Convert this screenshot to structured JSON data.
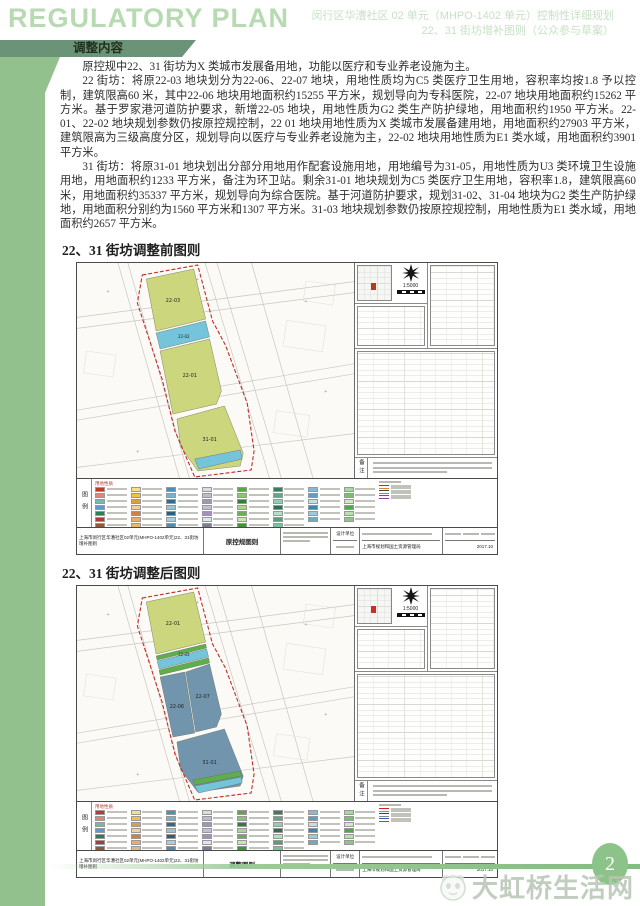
{
  "header": {
    "title_en": "REGULATORY PLAN",
    "subtitle_line1": "闵行区华漕社区 02 单元（MHPO-1402 单元）控制性详细规划",
    "subtitle_line2": "22、31 街坊增补图则（公众参与草案）",
    "section_banner": "调整内容"
  },
  "body": {
    "paragraphs": [
      "原控规中22、31 街坊为X 类城市发展备用地，功能以医疗和专业养老设施为主。",
      "22 街坊：将原22-03 地块划分为22-06、22-07 地块，用地性质均为C5 类医疗卫生用地，容积率均按1.8 予以控制，建筑限高60 米，其中22-06 地块用地面积约15255 平方米，规划导向为专科医院，22-07 地块用地面积约15262 平方米。基于罗家港河道防护要求，新增22-05 地块，用地性质为G2 类生产防护绿地，用地面积约1950 平方米。22-01、22-02 地块规划参数仍按原控规控制，22 01 地块用地性质为X 类城市发展备建用地，用地面积约27903 平方米，建筑限高为三级高度分区，规划导向以医疗与专业养老设施为主，22-02 地块用地性质为E1 类水域，用地面积约3901 平方米。",
      "31 街坊：将原31-01 地块划出分部分用地用作配套设施用地，用地编号为31-05，用地性质为U3 类环境卫生设施用地，用地面积约1233 平方米，备注为环卫站。剩余31-01 地块规划为C5 类医疗卫生用地，容积率1.8，建筑限高60 米，用地面积约35337 平方米，规划导向为综合医院。基于河道防护要求，规划31-02、31-04 地块为G2 类生产防护绿地，用地面积分别约为1560 平方米和1307 平方米。31-03 地块规划参数仍按原控规控制，用地性质为E1 类水域，用地面积约2657 平方米。"
    ]
  },
  "colors": {
    "boundary": "#c52a22",
    "parcel_yellow": "#ccd67d",
    "water_blue": "#74c4dc",
    "green_strip": "#5fae4e",
    "medical_blue": "#7195ad"
  },
  "maps": {
    "before": {
      "heading": "22、31 街坊调整前图则",
      "scale": "1:5000",
      "legend_label": "图例",
      "legend_section_title": "用地性质",
      "notes_label": "备注",
      "sheet_label": "原控规图则",
      "title_line1": "上海市闵行区华漕社区02单元(MHPO-1402单元)22、31街坊",
      "title_line2": "增补图则",
      "design_label": "设计单位",
      "authority": "上海市规划和国土资源管理局",
      "date": "2017.10",
      "boundary": "66,12 122,2 137,58 150,82 172,140 179,188 176,207 119,214 99,168 86,116 61,40",
      "parcels": [
        {
          "points": "70,16 118,6 130,56 80,68",
          "fill": "#ccd67d"
        },
        {
          "points": "80,70 130,58 134,74 84,86",
          "fill": "#74c4dc"
        },
        {
          "points": "84,88 134,76 146,128 141,141 97,151",
          "fill": "#ccd67d"
        },
        {
          "points": "101,156 149,143 168,190 165,203 122,208 105,184",
          "fill": "#ccd67d"
        },
        {
          "points": "119,196 165,187 167,196 123,206",
          "fill": "#74c4dc"
        }
      ],
      "labels": [
        {
          "text": "22-03",
          "x": 97,
          "y": 39,
          "s": 5
        },
        {
          "text": "22-02",
          "x": 108,
          "y": 75,
          "s": 4
        },
        {
          "text": "22-01",
          "x": 114,
          "y": 114,
          "s": 5
        },
        {
          "text": "31-01",
          "x": 134,
          "y": 178,
          "s": 5
        }
      ]
    },
    "after": {
      "heading": "22、31 街坊调整后图则",
      "scale": "1:5000",
      "legend_label": "图例",
      "legend_section_title": "用地性质",
      "notes_label": "备注",
      "sheet_label": "调整图则",
      "title_line1": "上海市闵行区华漕社区02单元(MHPO-1402单元)22、31街坊",
      "title_line2": "增补图则",
      "design_label": "设计单位",
      "authority": "上海市规划和国土资源管理局",
      "date": "2017.10",
      "boundary": "66,12 122,2 137,58 150,82 172,140 179,188 176,207 119,214 99,168 86,116 61,40",
      "parcels": [
        {
          "points": "70,16 118,6 130,56 80,68",
          "fill": "#ccd67d"
        },
        {
          "points": "80,70 130,58 131,62 81,74",
          "fill": "#5fae4e"
        },
        {
          "points": "81,75 131,63 133,71 83,83",
          "fill": "#74c4dc"
        },
        {
          "points": "83,84 133,72 134,77 84,89",
          "fill": "#5fae4e"
        },
        {
          "points": "84,91 109,86 119,147 97,151",
          "fill": "#7195ad"
        },
        {
          "points": "110,86 134,78 146,128 141,141 120,146",
          "fill": "#7195ad"
        },
        {
          "points": "101,156 149,143 168,190 165,200 122,206 105,184",
          "fill": "#7195ad"
        },
        {
          "points": "117,194 165,185 166,190 119,199",
          "fill": "#5fae4e"
        },
        {
          "points": "119,200 166,191 167,197 123,207",
          "fill": "#74c4dc"
        }
      ],
      "labels": [
        {
          "text": "22-01",
          "x": 97,
          "y": 39,
          "s": 5
        },
        {
          "text": "22-05",
          "x": 108,
          "y": 70,
          "s": 4
        },
        {
          "text": "22-06",
          "x": 101,
          "y": 122,
          "s": 5
        },
        {
          "text": "22-07",
          "x": 127,
          "y": 112,
          "s": 5
        },
        {
          "text": "31-01",
          "x": 134,
          "y": 178,
          "s": 5
        }
      ]
    }
  },
  "legend": {
    "color_columns": [
      [
        "#c0392b",
        "#d98880",
        "#76b7ae",
        "#5b9bd5",
        "#2e7d57",
        "#b03a2e",
        "#8e5a3a",
        "#d4c05a",
        "#c39bd3"
      ],
      [
        "#f4e08a",
        "#f0c04a",
        "#e09c3e",
        "#f0d0a0",
        "#d08040",
        "#eaaf60",
        "#d8c070",
        "#f0e0b0",
        "#caa84a"
      ],
      [
        "#4a90b8",
        "#74b4cc",
        "#356a8c",
        "#98c4d4",
        "#28607e",
        "#a8d0dc",
        "#5a8aa2",
        "#c08858",
        "#7898b0"
      ],
      [
        "#dcdcdc",
        "#bcbccb",
        "#9a9ab2",
        "#cabade",
        "#a98cc2",
        "#e4e4ec",
        "#7c7c94",
        "#b4a4ca",
        "#d0d0e0"
      ],
      [
        "#5aa648",
        "#8cc470",
        "#2f7e3e",
        "#aad492",
        "#68b058",
        "#cce4b4",
        "#479238",
        "#94c682",
        "#6fae5e"
      ],
      [
        "#3a7f5c",
        "#62a886",
        "#8fd0b0",
        "#2f6e50",
        "#b8dcc8",
        "#56a074",
        "#7cc09c",
        "#cfe8dc",
        "#449068"
      ],
      [
        "#88b8d8",
        "#58a0c8",
        "#c8dce8",
        "#3888b0",
        "#a0c8dc",
        "#70a8c8"
      ],
      [
        "#a8d8a0",
        "#78c070",
        "#d0e8c8",
        "#50a848",
        "#b8e0b0",
        "#88c880"
      ]
    ],
    "line_colors": [
      "#cc2222",
      "#e08030",
      "#444444",
      "#888888",
      "#3060c0",
      "#9040a0"
    ]
  },
  "footer": {
    "page_number": "2",
    "watermark": "大虹桥生活网"
  }
}
